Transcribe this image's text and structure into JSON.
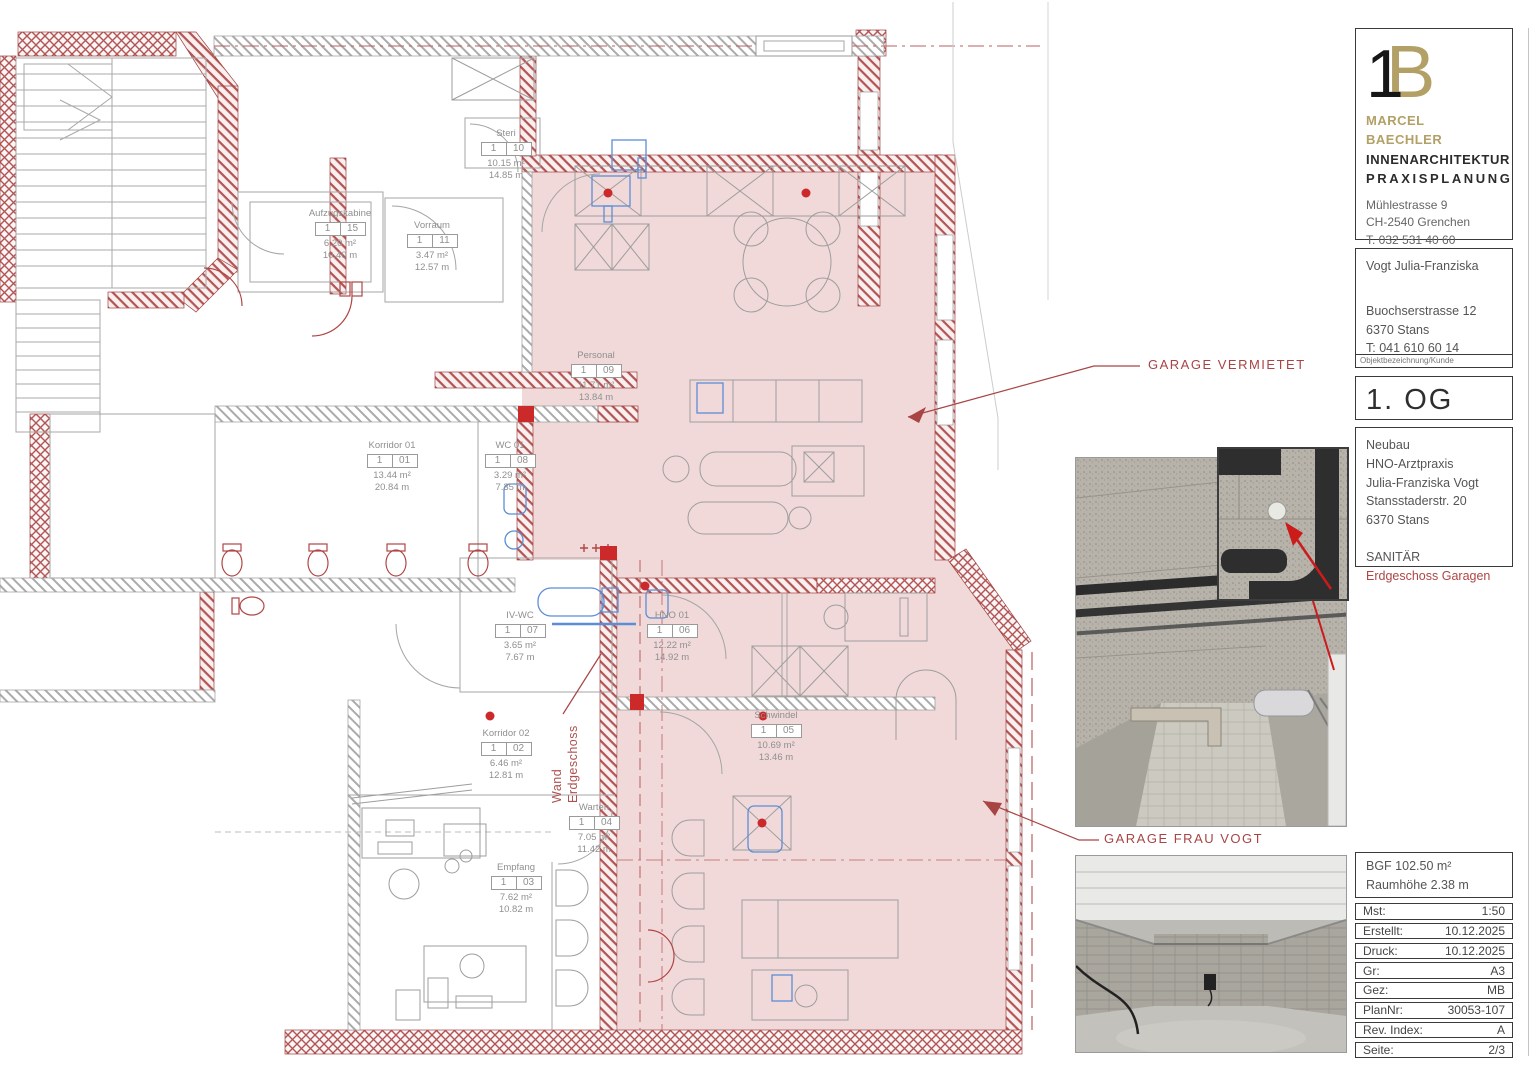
{
  "plan": {
    "rooms": [
      {
        "name": "Korridor 01",
        "floor": "1",
        "nr": "01",
        "area": "13.44 m²",
        "perimeter": "20.84 m"
      },
      {
        "name": "Korridor 02",
        "floor": "1",
        "nr": "02",
        "area": "6.46 m²",
        "perimeter": "12.81 m"
      },
      {
        "name": "Empfang",
        "floor": "1",
        "nr": "03",
        "area": "7.62 m²",
        "perimeter": "10.82 m"
      },
      {
        "name": "Warten",
        "floor": "1",
        "nr": "04",
        "area": "7.05 m²",
        "perimeter": "11.42 m"
      },
      {
        "name": "Schwindel",
        "floor": "1",
        "nr": "05",
        "area": "10.69 m²",
        "perimeter": "13.46 m"
      },
      {
        "name": "HNO 01",
        "floor": "1",
        "nr": "06",
        "area": "12.22 m²",
        "perimeter": "14.92 m"
      },
      {
        "name": "IV-WC",
        "floor": "1",
        "nr": "07",
        "area": "3.65 m²",
        "perimeter": "7.67 m"
      },
      {
        "name": "WC 01",
        "floor": "1",
        "nr": "08",
        "area": "3.29 m²",
        "perimeter": "7.35 m"
      },
      {
        "name": "Personal",
        "floor": "1",
        "nr": "09",
        "area": "11.71 m²",
        "perimeter": "13.84 m"
      },
      {
        "name": "Steri",
        "floor": "1",
        "nr": "10",
        "area": "10.15 m²",
        "perimeter": "14.85 m"
      },
      {
        "name": "Vorraum",
        "floor": "1",
        "nr": "11",
        "area": "3.47 m²",
        "perimeter": "12.57 m"
      },
      {
        "name": "Aufzugskabine",
        "floor": "1",
        "nr": "15",
        "area": "6.20 m²",
        "perimeter": "10.40 m"
      }
    ],
    "annotations": {
      "garage_vermietet": "GARAGE VERMIETET",
      "garage_frau_vogt": "GARAGE  FRAU VOGT",
      "wand_line1": "Wand",
      "wand_line2": "Erdgeschoss"
    },
    "colors": {
      "highlight": "#f1d9d9",
      "wall_red": "#b35454",
      "annotation_red": "#a84444",
      "fixture_blue": "#5b8ed6"
    }
  },
  "titleblock": {
    "company": {
      "logo_1": "1",
      "logo_b": "B",
      "name": "MARCEL BAECHLER",
      "line2": "INNENARCHITEKTUR",
      "line3": "PRAXISPLANUNG",
      "address1": "Mühlestrasse 9",
      "address2": "CH-2540 Grenchen",
      "phone": "T. 032 531 40 60",
      "email": "office@mbaechler.ch",
      "website": "marcelbaechler.ch",
      "accent": "#b3a066"
    },
    "client": {
      "name": "Vogt Julia-Franziska",
      "address1": "Buochserstrasse 12",
      "address2": "6370 Stans",
      "phone": "T: 041 610 60 14",
      "caption": "Objektbezeichnung/Kunde"
    },
    "plan_title": "1. OG",
    "project": {
      "line1": "Neubau",
      "line2": "HNO-Arztpraxis",
      "line3": "Julia-Franziska Vogt",
      "line4": "Stansstaderstr. 20",
      "line5": "6370 Stans",
      "trade": "SANITÄR",
      "trade_detail": "Erdgeschoss Garagen"
    },
    "metrics": {
      "bgf": "BGF 102.50 m²",
      "raumhoehe": "Raumhöhe 2.38 m"
    },
    "table": [
      {
        "label": "Mst:",
        "value": "1:50"
      },
      {
        "label": "Erstellt:",
        "value": "10.12.2025"
      },
      {
        "label": "Druck:",
        "value": "10.12.2025"
      },
      {
        "label": "Gr:",
        "value": "A3"
      },
      {
        "label": "Gez:",
        "value": "MB"
      },
      {
        "label": "PlanNr:",
        "value": "30053-107"
      },
      {
        "label": "Rev. Index:",
        "value": "A"
      },
      {
        "label": "Seite:",
        "value": "2/3"
      }
    ]
  }
}
